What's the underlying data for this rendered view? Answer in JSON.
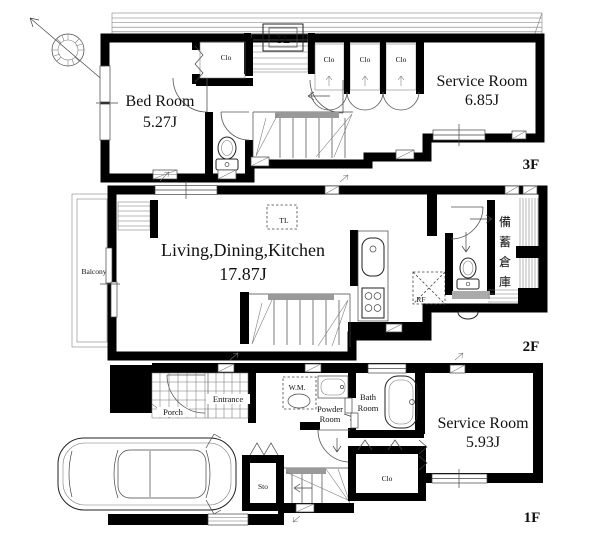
{
  "colors": {
    "wall": "#000000",
    "line": "#333333",
    "background": "#ffffff",
    "stair_landing": "#999999"
  },
  "compass": {
    "type": "north-arrow"
  },
  "floor3": {
    "label": "3F",
    "bed_room": {
      "name": "Bed Room",
      "area": "5.27J"
    },
    "service_room": {
      "name": "Service Room",
      "area": "6.85J"
    },
    "bedroom_closet": "Clo",
    "hall_closets": [
      "Clo",
      "Clo",
      "Clo"
    ],
    "toplight": "TL"
  },
  "floor2": {
    "label": "2F",
    "ldk": {
      "name": "Living,Dining,Kitchen",
      "area": "17.87J"
    },
    "balcony": "Balcony",
    "toplight": "TL",
    "refrigerator": "RF",
    "storage_room": "備蓄倉庫",
    "storage_chars": [
      "備",
      "蓄",
      "倉",
      "庫"
    ]
  },
  "floor1": {
    "label": "1F",
    "service_room": {
      "name": "Service Room",
      "area": "5.93J"
    },
    "porch": "Porch",
    "entrance": "Entrance",
    "washing_machine": "W.M.",
    "powder_room": [
      "Powder",
      "Room"
    ],
    "bath_room": [
      "Bath",
      "Room"
    ],
    "storage": "Sto",
    "closet": "Clo"
  }
}
